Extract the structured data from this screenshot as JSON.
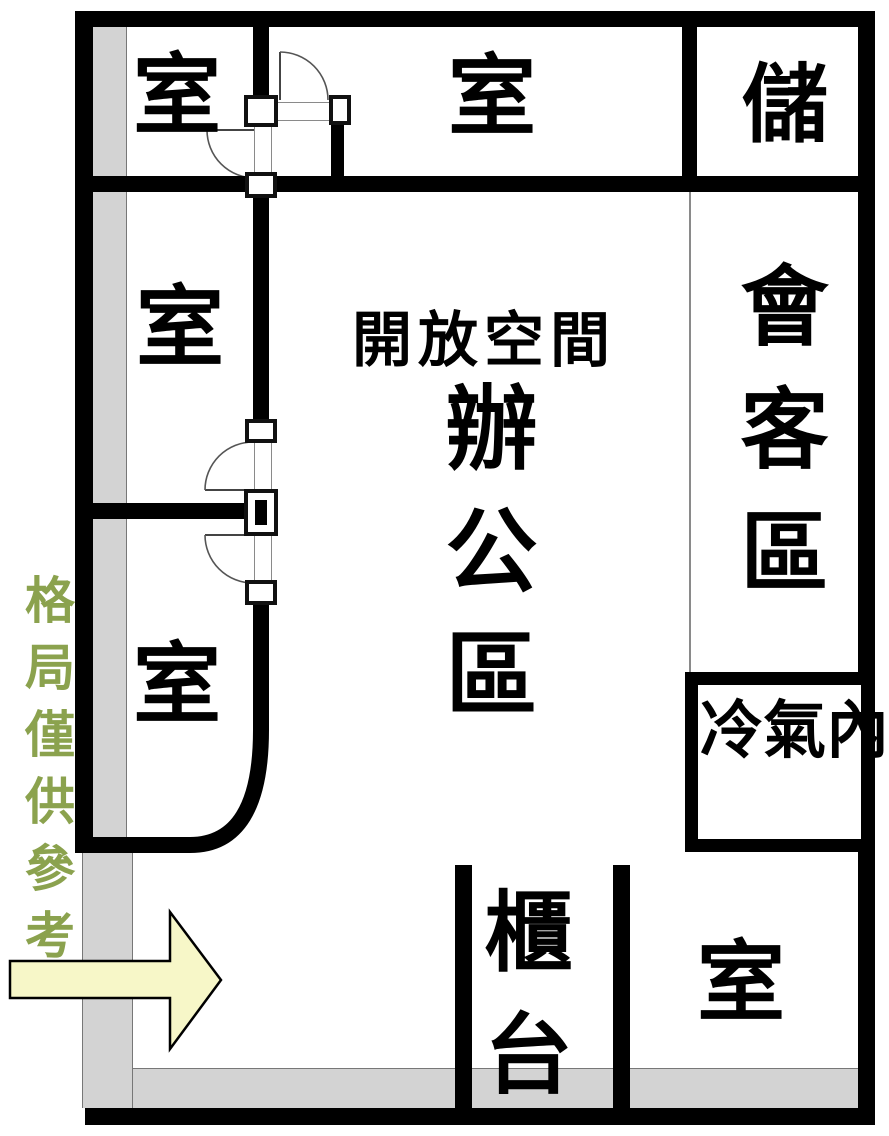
{
  "title": "floor-plan",
  "rooms": {
    "room_top_left": "室",
    "room_top_middle": "室",
    "storage": "儲",
    "reception": "會客區",
    "open_space_title": "開放空間",
    "open_space_name": "辦公區",
    "room_mid_left": "室",
    "room_bottom_left": "室",
    "ac_indoor_unit": "冷氣內機",
    "counter": "櫃台",
    "room_bottom_right": "室"
  },
  "disclaimer": "格局僅供參考",
  "icons": {
    "entrance_arrow": "right-arrow"
  },
  "colors": {
    "wall": "#000000",
    "gray_zone": "#d3d3d3",
    "arrow_fill": "#f7f7c8",
    "disclaimer_green": "#8ba24e",
    "label_text": "#000000",
    "background": "#ffffff"
  }
}
